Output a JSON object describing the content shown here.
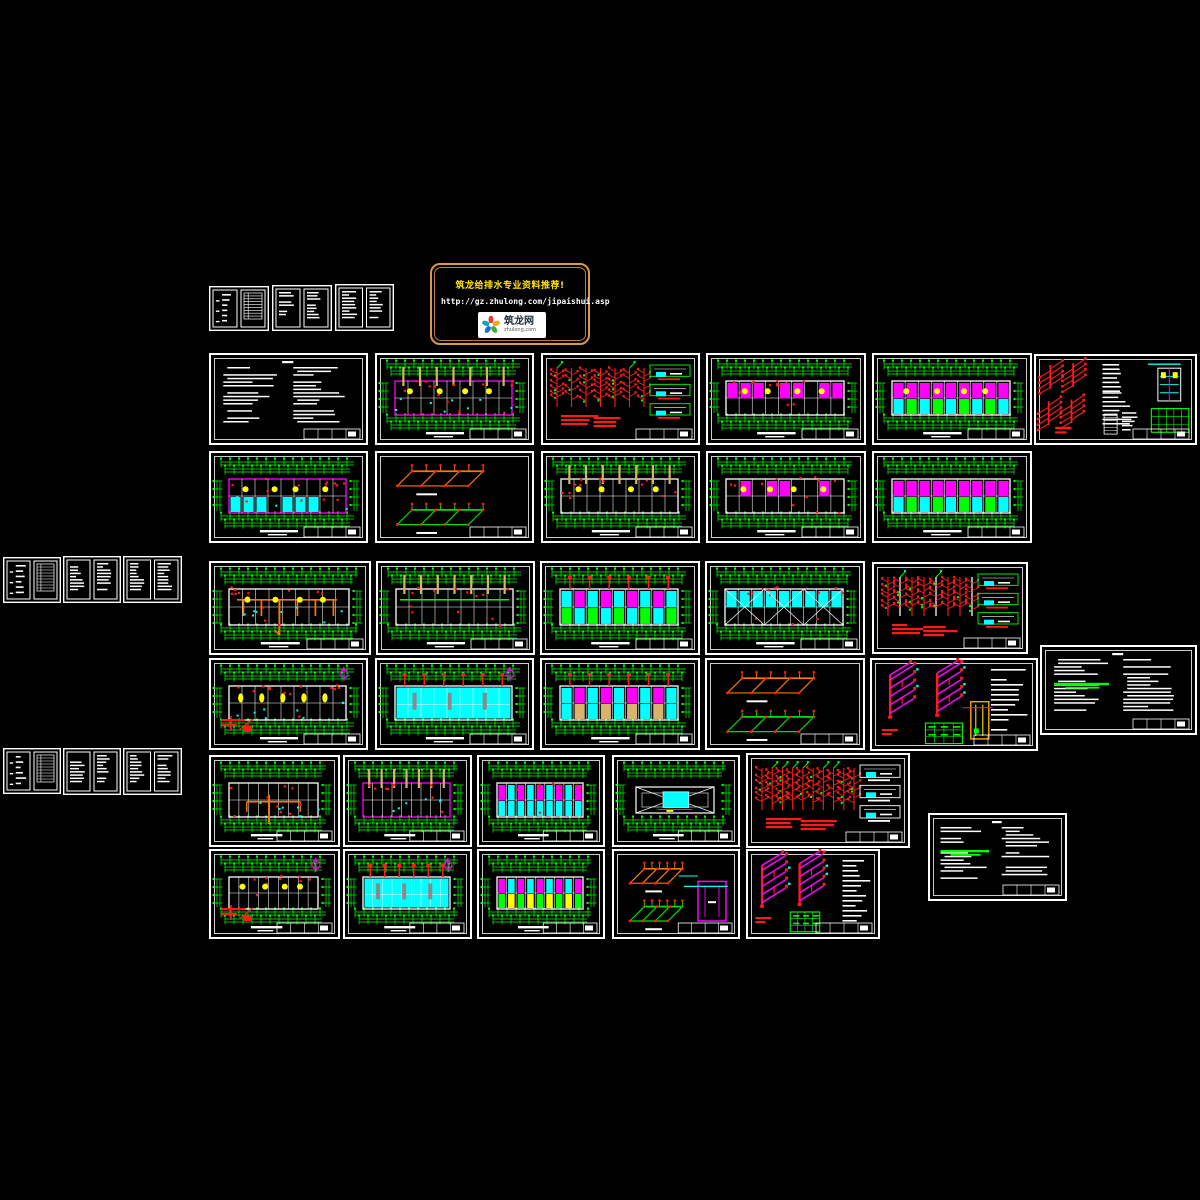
{
  "app": {
    "type": "cad-model-space-overview",
    "background": "#000000"
  },
  "banner": {
    "title": "筑龙给排水专业资料推荐!",
    "url": "http://gz.zhulong.com/jipaishui.asp",
    "logo": {
      "text": "筑龙网",
      "subtext": "zhulong.com"
    },
    "border_color": "#d89a44",
    "title_color": "#ffe400",
    "url_color": "#ffffff"
  },
  "palette": {
    "background": "#000000",
    "sheet_border": "#ffffff",
    "dim_green": "#00ff00",
    "pipe_red": "#ff1a1a",
    "wall_magenta": "#ff00ff",
    "fill_cyan": "#00ffff",
    "highlight_yellow": "#ffff00",
    "pipe_orange": "#ff7700",
    "column_tan": "#d8b36a",
    "iso_green": "#00dd00"
  },
  "sheets": [
    {
      "id": "a1",
      "kind": "docs",
      "x": 209,
      "y": 286,
      "w": 60,
      "h": 45,
      "panels": [
        "list",
        "table"
      ]
    },
    {
      "id": "a2",
      "kind": "docs",
      "x": 272,
      "y": 285,
      "w": 60,
      "h": 46,
      "panels": [
        "text",
        "text"
      ]
    },
    {
      "id": "a3",
      "kind": "docs",
      "x": 335,
      "y": 284,
      "w": 59,
      "h": 47,
      "panels": [
        "text",
        "text"
      ]
    },
    {
      "id": "b1",
      "kind": "docs",
      "x": 3,
      "y": 557,
      "w": 58,
      "h": 46,
      "panels": [
        "list",
        "table"
      ]
    },
    {
      "id": "b2",
      "kind": "docs",
      "x": 63,
      "y": 556,
      "w": 58,
      "h": 47,
      "panels": [
        "text",
        "text"
      ]
    },
    {
      "id": "b3",
      "kind": "docs",
      "x": 123,
      "y": 556,
      "w": 59,
      "h": 47,
      "panels": [
        "text",
        "text"
      ]
    },
    {
      "id": "c1",
      "kind": "docs",
      "x": 3,
      "y": 748,
      "w": 58,
      "h": 46,
      "panels": [
        "list",
        "table"
      ]
    },
    {
      "id": "c2",
      "kind": "docs",
      "x": 63,
      "y": 748,
      "w": 58,
      "h": 47,
      "panels": [
        "text",
        "text"
      ]
    },
    {
      "id": "c3",
      "kind": "docs",
      "x": 123,
      "y": 748,
      "w": 59,
      "h": 47,
      "panels": [
        "text",
        "text"
      ]
    },
    {
      "id": "s1",
      "kind": "doc",
      "x": 209,
      "y": 353,
      "w": 159,
      "h": 92
    },
    {
      "id": "s2",
      "kind": "plan",
      "x": 375,
      "y": 353,
      "w": 159,
      "h": 92,
      "wall": "#ff00ff",
      "tan": 1,
      "yellow": 1,
      "red": 1,
      "cyan": 1
    },
    {
      "id": "s3",
      "kind": "riser",
      "x": 541,
      "y": 353,
      "w": 159,
      "h": 92,
      "cols": 7,
      "line": "red",
      "details": "green"
    },
    {
      "id": "s4",
      "kind": "plan",
      "x": 706,
      "y": 353,
      "w": 160,
      "h": 92,
      "fillsTop": [
        "#ff00ff"
      ],
      "yellow": 1,
      "red": 1,
      "sparse": 1
    },
    {
      "id": "s5",
      "kind": "plan",
      "x": 872,
      "y": 353,
      "w": 160,
      "h": 92,
      "fillsTop": [
        "#ff00ff"
      ],
      "fillsBottom": [
        "#00ffff",
        "#00ff00"
      ],
      "yellow": 1
    },
    {
      "id": "s6",
      "kind": "detail",
      "x": 1034,
      "y": 354,
      "w": 163,
      "h": 91
    },
    {
      "id": "s7",
      "kind": "plan",
      "x": 209,
      "y": 451,
      "w": 159,
      "h": 92,
      "wall": "#ff00ff",
      "fillsBottom": [
        "#00ffff"
      ],
      "sparse": 1,
      "yellow": 1,
      "red": 1,
      "cyan": 1
    },
    {
      "id": "s8",
      "kind": "isoog",
      "x": 375,
      "y": 451,
      "w": 159,
      "h": 92
    },
    {
      "id": "s9",
      "kind": "plan",
      "x": 541,
      "y": 451,
      "w": 159,
      "h": 92,
      "tan": 1,
      "yellow": 1,
      "red": 1
    },
    {
      "id": "s10",
      "kind": "plan",
      "x": 706,
      "y": 451,
      "w": 160,
      "h": 92,
      "fillsTop": [
        "#ff00ff"
      ],
      "red": 1,
      "yellow": 1,
      "sparse": 1
    },
    {
      "id": "s11",
      "kind": "plan",
      "x": 872,
      "y": 451,
      "w": 160,
      "h": 92,
      "fillsTop": [
        "#ff00ff"
      ],
      "fillsBottom": [
        "#00ffff",
        "#00ff00"
      ]
    },
    {
      "id": "s12",
      "kind": "plan",
      "x": 209,
      "y": 561,
      "w": 162,
      "h": 94,
      "orange": 1,
      "cyan": 1,
      "red": 1,
      "yellow": 1
    },
    {
      "id": "s13",
      "kind": "plan",
      "x": 376,
      "y": 561,
      "w": 159,
      "h": 94,
      "tan": 1,
      "greenMain": 1,
      "red": 1
    },
    {
      "id": "s14",
      "kind": "plan",
      "x": 540,
      "y": 561,
      "w": 160,
      "h": 94,
      "fillsTop": [
        "#00ffff",
        "#ff00ff"
      ],
      "fillsBottom": [
        "#00ff00",
        "#00ffff"
      ],
      "redTop": 1
    },
    {
      "id": "s15",
      "kind": "plan",
      "x": 705,
      "y": 561,
      "w": 160,
      "h": 94,
      "fillsTop": [
        "#00ffff"
      ],
      "xbrace": 1,
      "red": 1
    },
    {
      "id": "s16",
      "kind": "riser",
      "x": 872,
      "y": 562,
      "w": 156,
      "h": 92,
      "cols": 8,
      "line": "mix",
      "details": "green"
    },
    {
      "id": "s17",
      "kind": "plan",
      "x": 209,
      "y": 658,
      "w": 159,
      "h": 92,
      "yellowOval": 1,
      "red": 1,
      "cyan": 1,
      "redDetail": 1,
      "compass": 1
    },
    {
      "id": "s18",
      "kind": "plan",
      "x": 375,
      "y": 658,
      "w": 159,
      "h": 92,
      "fullFill": "#00ffff",
      "redTop": 1,
      "compass": 1
    },
    {
      "id": "s19",
      "kind": "plan",
      "x": 540,
      "y": 658,
      "w": 160,
      "h": 92,
      "fillsTop": [
        "#00ffff",
        "#ff00ff"
      ],
      "fillsBottom": [
        "#00ffff",
        "#d8b36a"
      ],
      "redTop": 1
    },
    {
      "id": "s20",
      "kind": "isoog",
      "x": 705,
      "y": 658,
      "w": 160,
      "h": 92
    },
    {
      "id": "s21",
      "kind": "isomag",
      "x": 870,
      "y": 658,
      "w": 168,
      "h": 93,
      "table": 1,
      "tank": "yellow",
      "text": 1
    },
    {
      "id": "s22",
      "kind": "doc",
      "x": 1040,
      "y": 645,
      "w": 157,
      "h": 90,
      "green": 1
    },
    {
      "id": "s23",
      "kind": "plan",
      "x": 209,
      "y": 755,
      "w": 131,
      "h": 92,
      "cyan": 1,
      "orangeTree": 1,
      "red": 1
    },
    {
      "id": "s24",
      "kind": "plan",
      "x": 343,
      "y": 755,
      "w": 129,
      "h": 92,
      "wall": "#ff00ff",
      "tan": 1,
      "red": 1,
      "cyan": 1
    },
    {
      "id": "s25",
      "kind": "plan",
      "x": 477,
      "y": 755,
      "w": 128,
      "h": 92,
      "fillsTop": [
        "#ff00ff",
        "#00ffff"
      ],
      "fillsBottom": [
        "#00ffff"
      ],
      "red": 1
    },
    {
      "id": "s26",
      "kind": "plan",
      "x": 612,
      "y": 755,
      "w": 128,
      "h": 92,
      "roof": 1
    },
    {
      "id": "s27",
      "kind": "riser",
      "x": 746,
      "y": 753,
      "w": 164,
      "h": 95,
      "cols": 10,
      "line": "red",
      "details": "white"
    },
    {
      "id": "s28",
      "kind": "plan",
      "x": 209,
      "y": 849,
      "w": 131,
      "h": 90,
      "red": 1,
      "redDetail": 1,
      "compass": 1,
      "yellow": 1
    },
    {
      "id": "s29",
      "kind": "plan",
      "x": 343,
      "y": 849,
      "w": 129,
      "h": 90,
      "fullFill": "#00ffff",
      "redTop": 1,
      "compass": 1
    },
    {
      "id": "s30",
      "kind": "plan",
      "x": 477,
      "y": 849,
      "w": 128,
      "h": 90,
      "fillsTop": [
        "#ff00ff",
        "#00ffff"
      ],
      "fillsBottom": [
        "#00ff00",
        "#ffff00"
      ]
    },
    {
      "id": "s31",
      "kind": "isoog",
      "x": 612,
      "y": 849,
      "w": 128,
      "h": 90,
      "tank": "magenta"
    },
    {
      "id": "s32",
      "kind": "isomag",
      "x": 746,
      "y": 849,
      "w": 134,
      "h": 90,
      "table": 1,
      "text": 1
    },
    {
      "id": "s33",
      "kind": "doc",
      "x": 928,
      "y": 813,
      "w": 139,
      "h": 88,
      "green": 1
    }
  ]
}
